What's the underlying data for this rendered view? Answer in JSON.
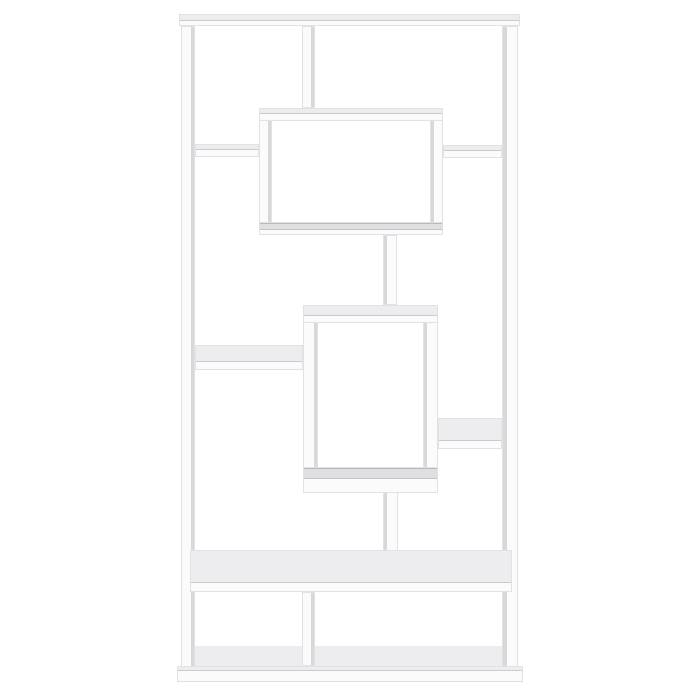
{
  "scene": {
    "description": "White geometric etagere bookcase photographed straight-on against a plain white background",
    "type": "product-photo",
    "background": "#ffffff"
  },
  "colors": {
    "background": "#ffffff",
    "boardFront": "#fbfbfc",
    "boardEdge": "#e6e6e8",
    "topFace": "#ededef",
    "sideFace": "#d8d8da",
    "innerFace": "#dfdfe1"
  },
  "bookcase": {
    "name": "geometric-etagere-bookcase",
    "finish": "white",
    "parts": [
      {
        "name": "base-top-surface",
        "x": 194,
        "y": 646,
        "w": 308,
        "h": 20,
        "fill": "topFace",
        "flat": true
      },
      {
        "name": "top-board",
        "x": 179,
        "y": 14,
        "w": 341,
        "h": 12,
        "faces": [
          {
            "side": "top",
            "size": 5,
            "color": "topFace"
          }
        ]
      },
      {
        "name": "left-post",
        "x": 181,
        "y": 26,
        "w": 14,
        "h": 647,
        "faces": [
          {
            "side": "right",
            "size": 3,
            "color": "sideFace"
          }
        ]
      },
      {
        "name": "right-post",
        "x": 502,
        "y": 26,
        "w": 16,
        "h": 647,
        "faces": [
          {
            "side": "left",
            "size": 4,
            "color": "sideFace"
          }
        ]
      },
      {
        "name": "plinth-base",
        "x": 177,
        "y": 666,
        "w": 346,
        "h": 16,
        "faces": [
          {
            "side": "top",
            "size": 3,
            "color": "topFace"
          }
        ]
      },
      {
        "name": "top-divider",
        "x": 302,
        "y": 26,
        "w": 13,
        "h": 82,
        "faces": [
          {
            "side": "right",
            "size": 3,
            "color": "sideFace"
          }
        ]
      },
      {
        "name": "upper-box-left-wall",
        "x": 259,
        "y": 108,
        "w": 13,
        "h": 127,
        "faces": [
          {
            "side": "right",
            "size": 3,
            "color": "sideFace"
          }
        ]
      },
      {
        "name": "upper-box-right-wall",
        "x": 430,
        "y": 108,
        "w": 13,
        "h": 127,
        "faces": [
          {
            "side": "left",
            "size": 3,
            "color": "sideFace"
          }
        ]
      },
      {
        "name": "upper-box-top",
        "x": 259,
        "y": 108,
        "w": 184,
        "h": 13,
        "faces": [
          {
            "side": "top",
            "size": 4,
            "color": "topFace"
          }
        ]
      },
      {
        "name": "upper-box-bottom",
        "x": 259,
        "y": 222,
        "w": 184,
        "h": 13,
        "faces": [
          {
            "side": "top",
            "size": 5,
            "color": "innerFace"
          }
        ]
      },
      {
        "name": "left-shelf-upper",
        "x": 195,
        "y": 144,
        "w": 64,
        "h": 13,
        "faces": [
          {
            "side": "top",
            "size": 4,
            "color": "topFace"
          }
        ]
      },
      {
        "name": "right-shelf-upper",
        "x": 443,
        "y": 145,
        "w": 59,
        "h": 13,
        "faces": [
          {
            "side": "top",
            "size": 4,
            "color": "topFace"
          }
        ]
      },
      {
        "name": "connector-stem-upper",
        "x": 383,
        "y": 235,
        "w": 14,
        "h": 70,
        "faces": [
          {
            "side": "left",
            "size": 3,
            "color": "sideFace"
          }
        ]
      },
      {
        "name": "left-shelf-middle",
        "x": 195,
        "y": 345,
        "w": 108,
        "h": 25,
        "faces": [
          {
            "side": "top",
            "size": 15,
            "color": "topFace"
          }
        ]
      },
      {
        "name": "lower-box-left-wall",
        "x": 303,
        "y": 305,
        "w": 15,
        "h": 187,
        "faces": [
          {
            "side": "right",
            "size": 3,
            "color": "sideFace"
          }
        ]
      },
      {
        "name": "lower-box-right-wall",
        "x": 423,
        "y": 305,
        "w": 15,
        "h": 187,
        "faces": [
          {
            "side": "left",
            "size": 3,
            "color": "sideFace"
          }
        ]
      },
      {
        "name": "lower-box-top",
        "x": 303,
        "y": 305,
        "w": 135,
        "h": 18,
        "faces": [
          {
            "side": "top",
            "size": 9,
            "color": "topFace"
          }
        ]
      },
      {
        "name": "lower-box-bottom",
        "x": 303,
        "y": 467,
        "w": 135,
        "h": 26,
        "faces": [
          {
            "side": "top",
            "size": 9,
            "color": "innerFace"
          }
        ]
      },
      {
        "name": "right-shelf-middle",
        "x": 438,
        "y": 418,
        "w": 64,
        "h": 31,
        "faces": [
          {
            "side": "top",
            "size": 21,
            "color": "topFace"
          }
        ]
      },
      {
        "name": "connector-stem-lower",
        "x": 383,
        "y": 492,
        "w": 15,
        "h": 59,
        "faces": [
          {
            "side": "left",
            "size": 3,
            "color": "sideFace"
          }
        ]
      },
      {
        "name": "long-shelf",
        "x": 190,
        "y": 550,
        "w": 322,
        "h": 42,
        "faces": [
          {
            "side": "top",
            "size": 31,
            "color": "topFace"
          }
        ]
      },
      {
        "name": "bottom-divider",
        "x": 302,
        "y": 592,
        "w": 13,
        "h": 74,
        "faces": [
          {
            "side": "right",
            "size": 3,
            "color": "sideFace"
          }
        ]
      }
    ]
  }
}
